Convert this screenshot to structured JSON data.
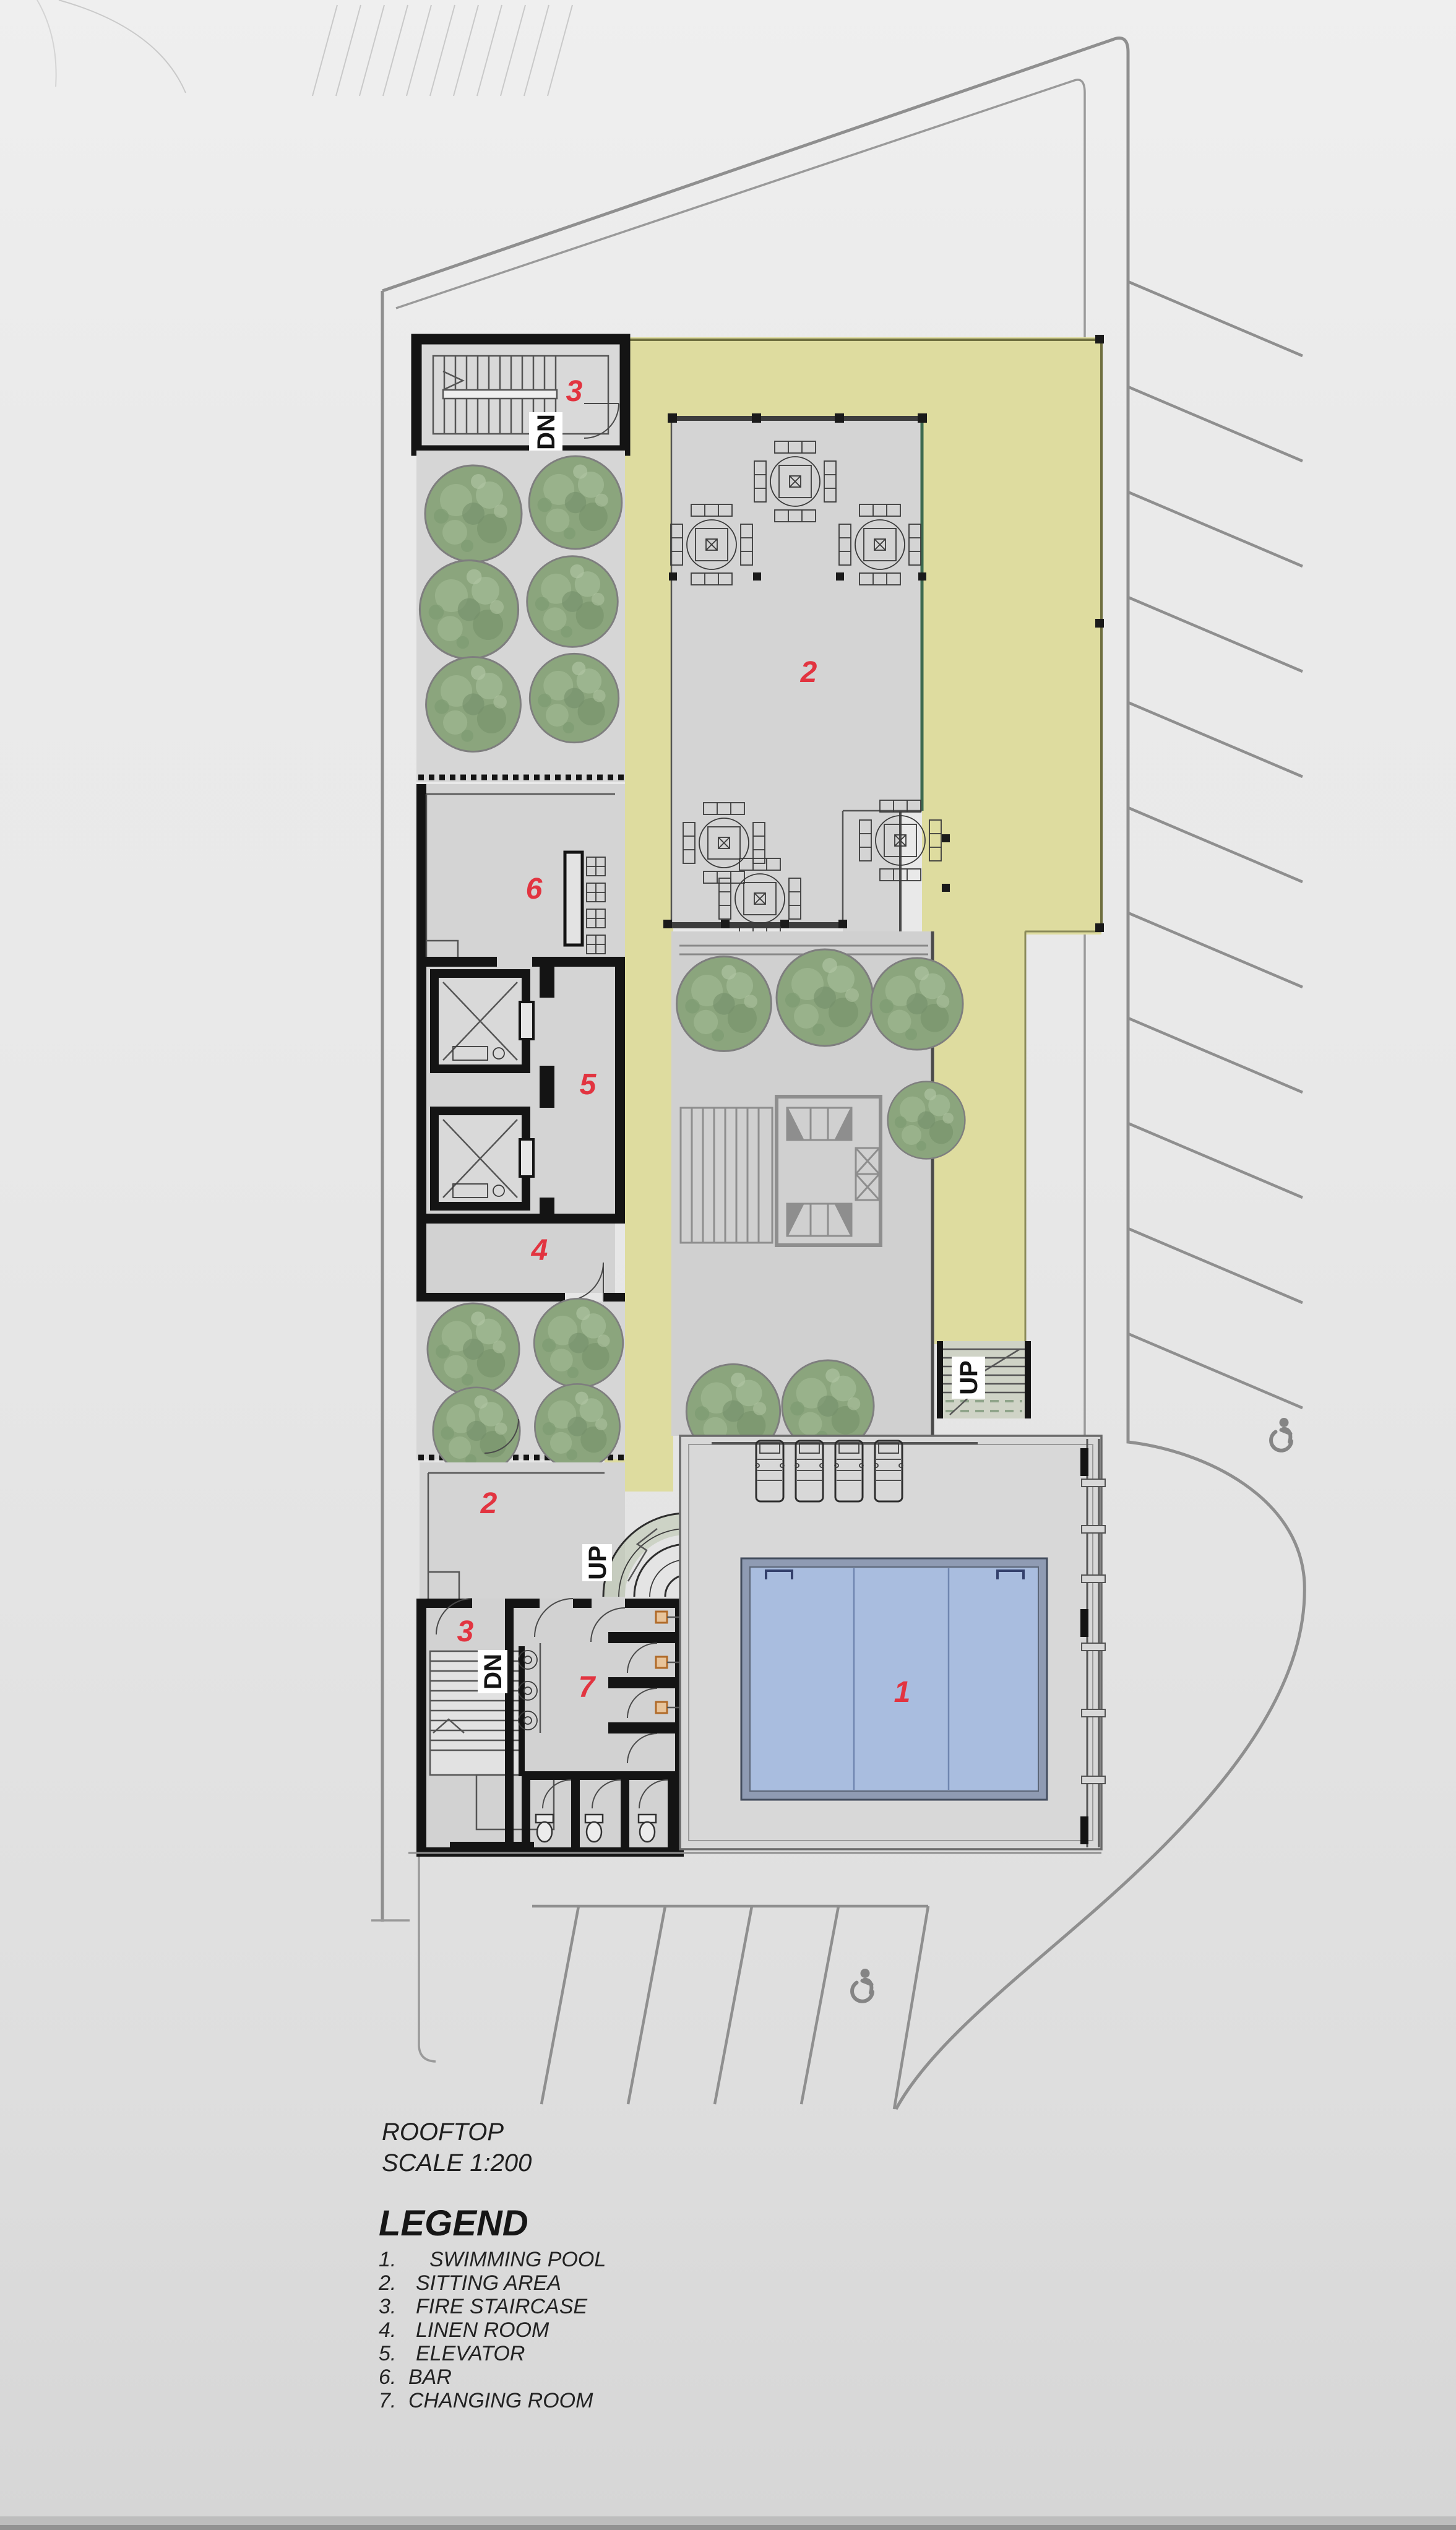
{
  "document": {
    "title": "ROOFTOP",
    "scale": "SCALE 1:200"
  },
  "legend": {
    "heading": "LEGEND",
    "items": [
      {
        "num": "1.",
        "label": "SWIMMING POOL"
      },
      {
        "num": "2.",
        "label": "SITTING AREA"
      },
      {
        "num": "3.",
        "label": "FIRE STAIRCASE"
      },
      {
        "num": "4.",
        "label": "LINEN ROOM"
      },
      {
        "num": "5.",
        "label": "ELEVATOR"
      },
      {
        "num": "6.",
        "label": "BAR"
      },
      {
        "num": "7.",
        "label": "CHANGING ROOM"
      }
    ]
  },
  "plan": {
    "room_labels": {
      "swimming_pool": "1",
      "sitting_area_upper": "2",
      "sitting_area_lower": "2",
      "fire_staircase_top": "3",
      "fire_staircase_bottom": "3",
      "linen_room": "4",
      "elevator": "5",
      "bar": "6",
      "changing_room": "7"
    },
    "direction_labels": {
      "stair_top_dn": "DN",
      "stair_bottom_dn": "DN",
      "stair_right_up": "UP",
      "stair_lower_up": "UP"
    },
    "icons": [
      "accessible-parking-icon",
      "accessible-parking-icon"
    ]
  },
  "colors": {
    "background": "#e8e8e8",
    "terrace_khaki": "#dedc9f",
    "floor_gray": "#d4d4d4",
    "pool_water": "#a9bddf",
    "pool_rim": "#8f9bb3",
    "wall_black": "#141414",
    "label_red": "#e23440",
    "tree_green": "#8ba57d",
    "road_gray": "#8f8f8f"
  }
}
